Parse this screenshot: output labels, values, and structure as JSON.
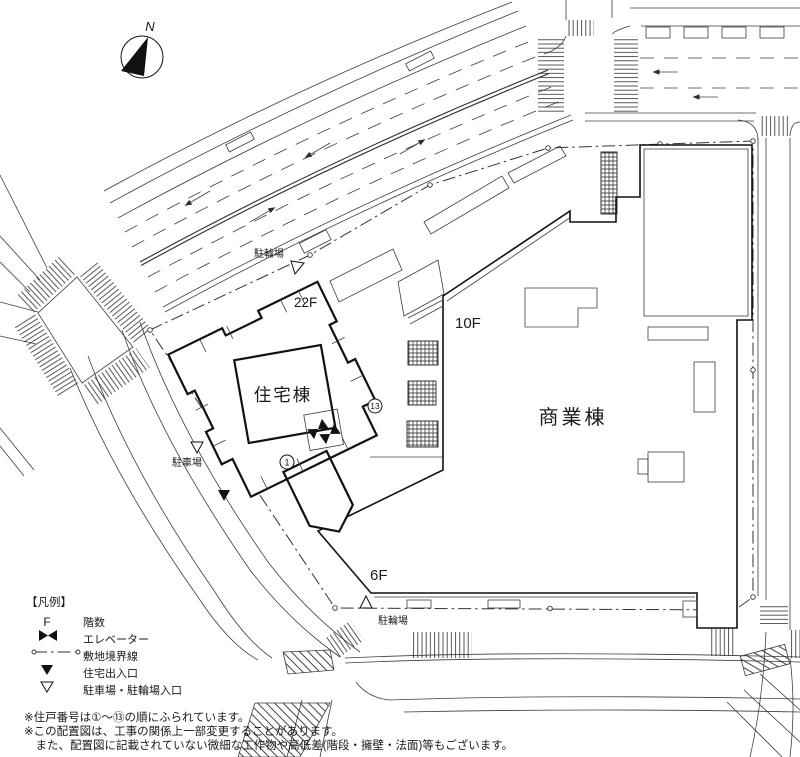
{
  "compass": {
    "north_label": "N"
  },
  "buildings": {
    "residential": {
      "name": "住宅棟",
      "floors": "22F",
      "unit_first": "1",
      "unit_last": "13"
    },
    "commercial": {
      "name": "商業棟",
      "floors_main": "10F",
      "floors_low": "6F"
    }
  },
  "site": {
    "bicycle_parking_north": "駐輪場",
    "bicycle_parking_south": "駐輪場",
    "car_parking": "駐車場"
  },
  "legend": {
    "title": "【凡例】",
    "items": [
      {
        "symbol": "F",
        "label": "階数"
      },
      {
        "symbol": "elevator-icon",
        "label": "エレベーター"
      },
      {
        "symbol": "boundary-line",
        "label": "敷地境界線"
      },
      {
        "symbol": "filled-triangle",
        "label": "住宅出入口"
      },
      {
        "symbol": "open-triangle",
        "label": "駐車場・駐輪場入口"
      }
    ]
  },
  "notes": [
    "※住戸番号は①〜⑬の順にふられています。",
    "※この配置図は、工事の関係上一部変更することがあります。",
    "　また、配置図に記載されていない微細な工作物や高低差(階段・擁壁・法面)等もございます。"
  ],
  "colors": {
    "ink": "#1a1a1a",
    "background": "#ffffff"
  }
}
